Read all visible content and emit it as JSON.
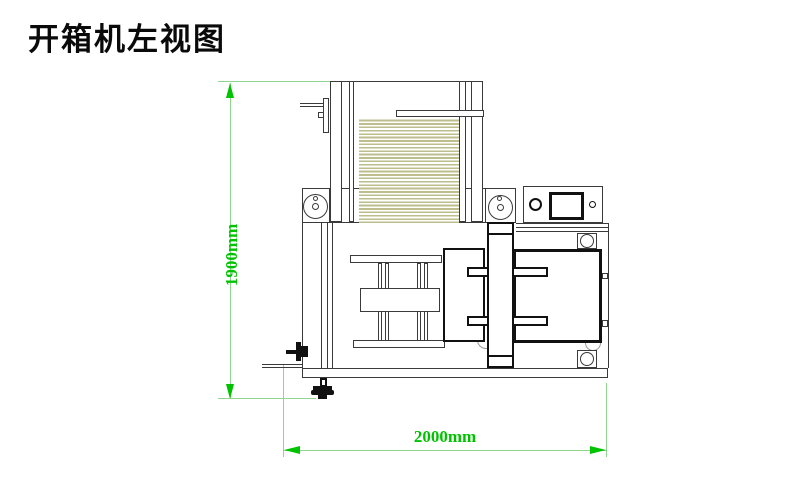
{
  "title": "开箱机左视图",
  "drawing": {
    "machine": "开箱机",
    "view": "左视图",
    "dimensions": {
      "height": {
        "label": "1900mm",
        "value": 1900,
        "unit": "mm"
      },
      "width": {
        "label": "2000mm",
        "value": 2000,
        "unit": "mm"
      }
    },
    "colors": {
      "dimension_line": "#8fd48f",
      "dimension_accent": "#00c300",
      "outline": "#3a3a3a",
      "bold_outline": "#111111",
      "stack_stripe": "#bdbd8e",
      "arc_gray": "#999999"
    }
  }
}
